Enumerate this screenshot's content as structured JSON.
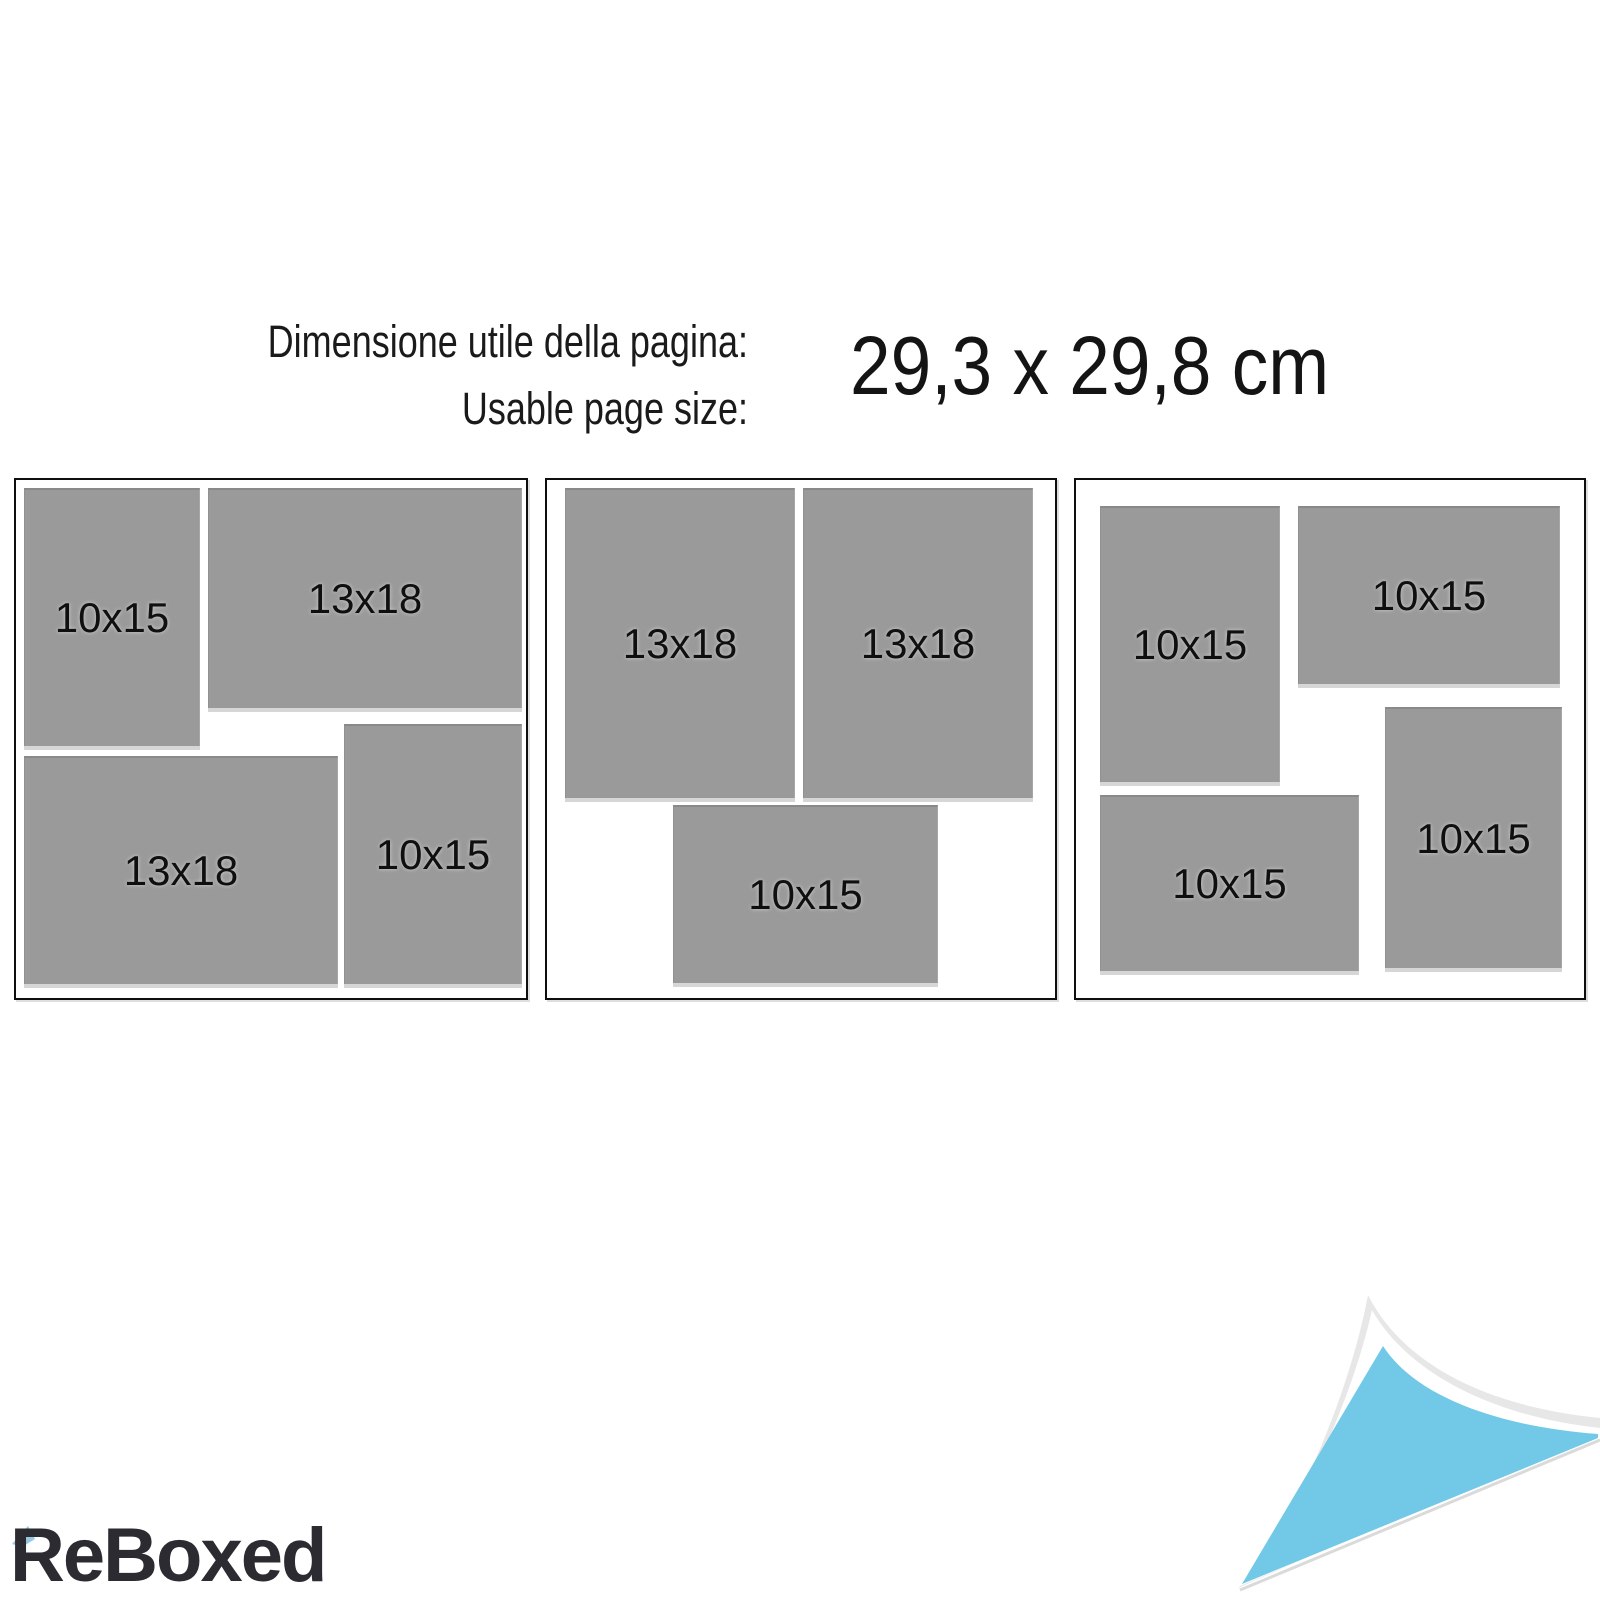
{
  "header": {
    "label_italian": "Dimensione utile della pagina:",
    "label_english": "Usable page size:",
    "page_size": "29,3 x 29,8 cm"
  },
  "layouts": [
    {
      "name": "layout-1",
      "slots": [
        {
          "label": "10x15"
        },
        {
          "label": "13x18"
        },
        {
          "label": "13x18"
        },
        {
          "label": "10x15"
        }
      ]
    },
    {
      "name": "layout-2",
      "slots": [
        {
          "label": "13x18"
        },
        {
          "label": "13x18"
        },
        {
          "label": "10x15"
        }
      ]
    },
    {
      "name": "layout-3",
      "slots": [
        {
          "label": "10x15"
        },
        {
          "label": "10x15"
        },
        {
          "label": "10x15"
        },
        {
          "label": "10x15"
        }
      ]
    }
  ],
  "branding": {
    "logo": "ReBoxed"
  },
  "colors": {
    "photo_placeholder": "#9a9a9a",
    "accent_blue": "#72c8e7",
    "curl_edge_gray": "#e7e7e7",
    "logo_dark": "#2b2b31"
  }
}
